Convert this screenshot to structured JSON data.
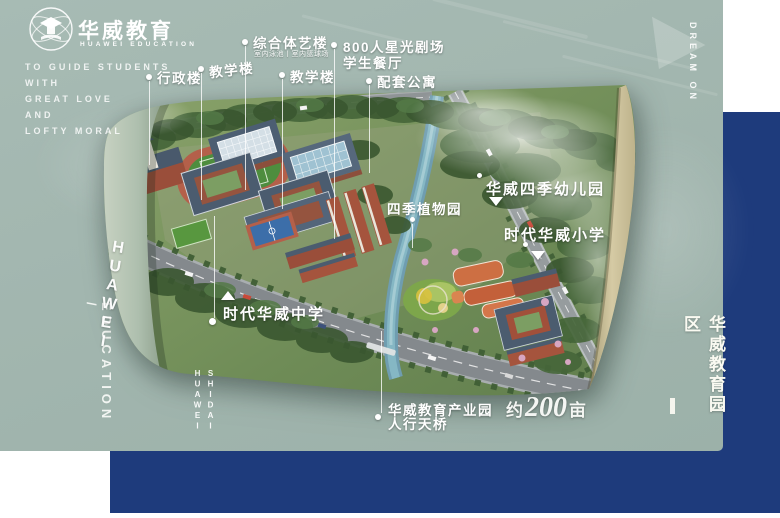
{
  "colors": {
    "page_bg": "#ffffff",
    "teal_panel": "#a2b6af",
    "navy_panel": "#1e3b7c",
    "label_text": "#ffffff"
  },
  "brand": {
    "logo_icon": "globe-education-emblem",
    "name_cn": "华威教育",
    "name_en": "HUAWEI EDUCATION",
    "slogan_lines": [
      "TO GUIDE STUDENTS",
      "WITH",
      "GREAT LOVE",
      "AND",
      "LOFTY MORAL"
    ]
  },
  "side_texts": {
    "left_vertical": "EDUCATION /",
    "top_right_vertical": "DREAM ON",
    "top_right_icon": "triangle-right",
    "right_vertical": "华威教育园区"
  },
  "map": {
    "road_label_main": "HUAWEI",
    "road_label_secondary_col1": "SHIDAI",
    "road_label_secondary_col2": "HUAWEI",
    "area_label": {
      "prefix": "约",
      "number": "200",
      "unit": "亩"
    },
    "callouts": [
      {
        "label": "行政楼"
      },
      {
        "label": "教学楼"
      },
      {
        "label": "综合体艺楼",
        "sublabel": "室内泳池丨室内篮球场"
      },
      {
        "label": "800人星光剧场",
        "label2": "学生餐厅"
      },
      {
        "label": "教学楼"
      },
      {
        "label": "配套公寓"
      }
    ],
    "site_labels": {
      "middle_school": "时代华威中学",
      "garden": "四季植物园",
      "kindergarten": "华威四季幼儿园",
      "primary_school": "时代华威小学",
      "industry_park": "华威教育产业园",
      "industry_park_line2": "人行天桥"
    }
  }
}
